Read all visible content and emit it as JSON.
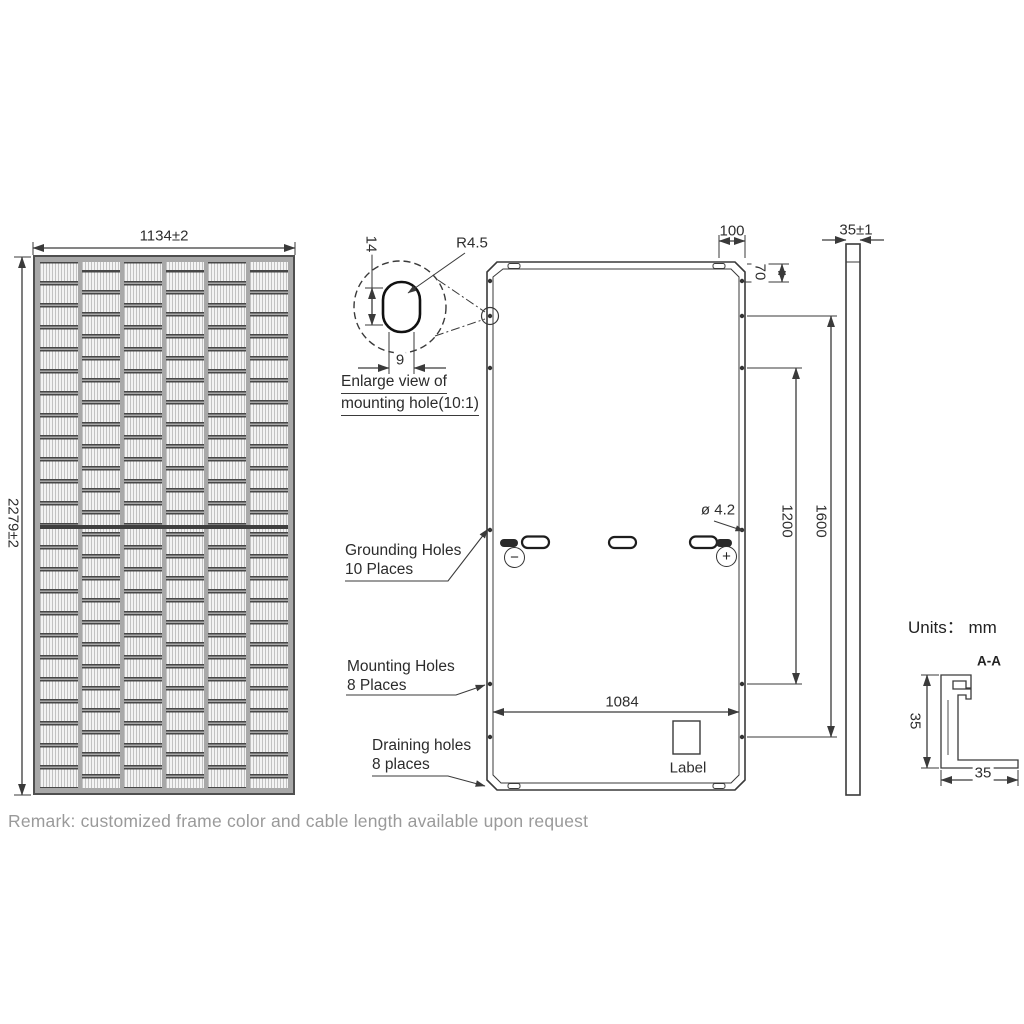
{
  "front_view": {
    "width_dim": "1134±2",
    "height_dim": "2279±2"
  },
  "enlarge_view": {
    "height_dim": "14",
    "radius_label": "R4.5",
    "width_dim": "9",
    "caption_line1": "Enlarge view of",
    "caption_line2": "mounting hole(10:1)"
  },
  "rear_view": {
    "corner_offset_dim": "100",
    "top_hole_offset_dim": "70",
    "hole_dia_dim": "ø 4.2",
    "mount_span_inner_dim": "1200",
    "mount_span_outer_dim": "1600",
    "bottom_width_dim": "1084",
    "label_text": "Label",
    "minus_symbol": "−",
    "plus_symbol": "+",
    "grounding_note_line1": "Grounding Holes",
    "grounding_note_line2": "10 Places",
    "mounting_note_line1": "Mounting Holes",
    "mounting_note_line2": "8 Places",
    "draining_note_line1": "Draining holes",
    "draining_note_line2": "8 places"
  },
  "side_view": {
    "thickness_dim": "35±1"
  },
  "section_view": {
    "units_label": "Units： mm",
    "section_label": "A-A",
    "height_dim": "35",
    "width_dim": "35"
  },
  "remark": "Remark: customized frame color and cable length available upon request",
  "colors": {
    "line": "#3a3a3a",
    "remark_text": "#9a9a9a",
    "cell_frame": "#a8a8a8"
  }
}
